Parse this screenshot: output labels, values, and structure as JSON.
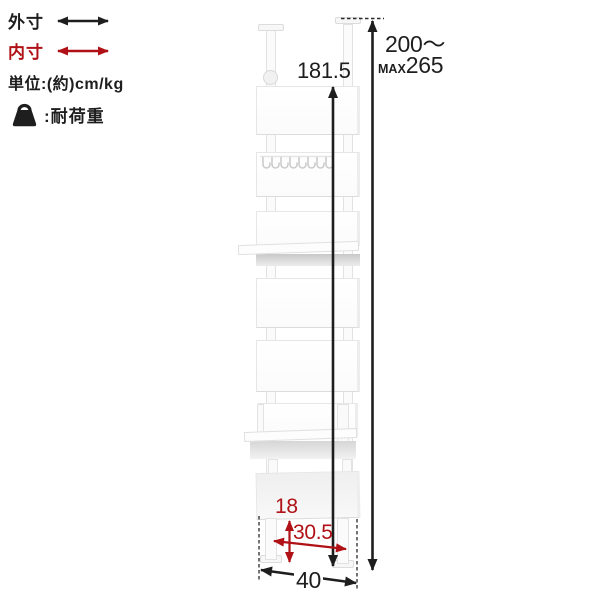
{
  "colors": {
    "text_black": "#1e1e1e",
    "accent_red": "#b01116",
    "panel_edge": "#e4e4e4",
    "shelf_shadow": "#c9c9c9",
    "background": "#ffffff"
  },
  "legend": {
    "outer_dim_label": "外寸",
    "inner_dim_label": "内寸",
    "unit_label": "単位:(約)cm/kg",
    "load_capacity_label": ":耐荷重",
    "outer_arrow_icon": "black-double-arrow",
    "inner_arrow_icon": "red-double-arrow",
    "load_icon": "weight-icon"
  },
  "dimensions": {
    "inner_height": "181.5",
    "outer_height_range": "200～",
    "outer_height_max_prefix": "MAX",
    "outer_height_max": "265",
    "base_clearance_height": "18",
    "inner_base_width": "30.5",
    "outer_width": "40"
  }
}
